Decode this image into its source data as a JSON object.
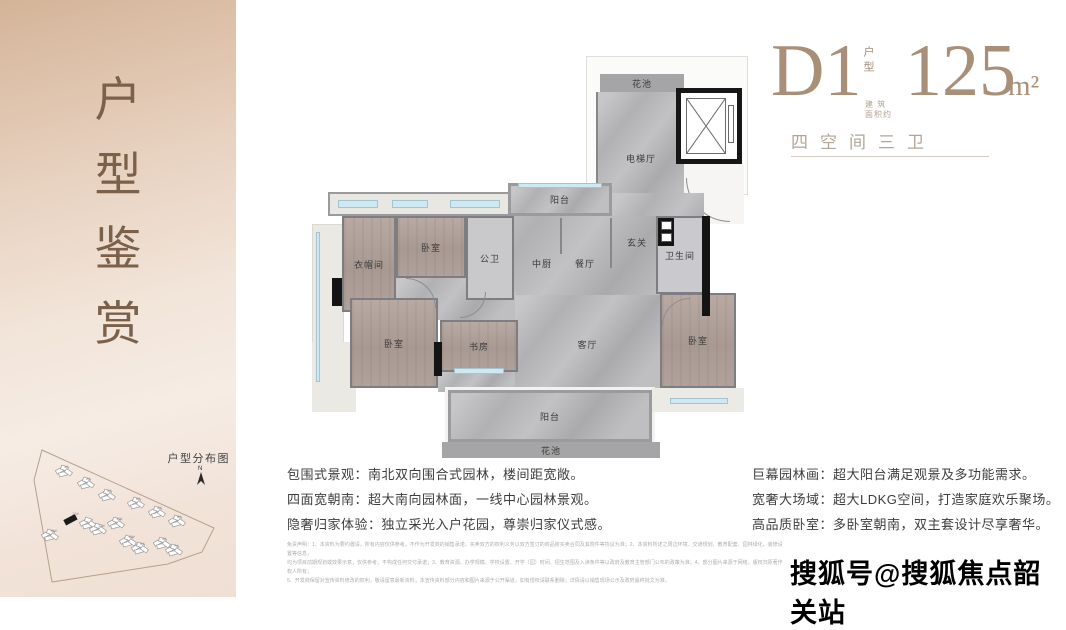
{
  "sidebar": {
    "title_chars": [
      "户",
      "型",
      "鉴",
      "赏"
    ],
    "sitemap": {
      "title": "户型分布图",
      "north_label": "N",
      "buildings": [
        "1#",
        "2#",
        "3#",
        "6#",
        "5#",
        "8#",
        "13#",
        "12#",
        "11#",
        "15#",
        "10#",
        "9#",
        "4#",
        "7#"
      ]
    }
  },
  "header": {
    "unit_code": "D1",
    "unit_code_note": "户型",
    "area_value": "125",
    "area_unit": "m²",
    "area_note_line1": "建 筑",
    "area_note_line2": "面积约",
    "subtitle": "四空间三卫"
  },
  "floorplan": {
    "rooms": {
      "flower_bed_top": "花池",
      "elevator_hall": "电梯厅",
      "balcony_top": "阳台",
      "bedroom_top": "卧室",
      "cloakroom": "衣帽间",
      "public_bath": "公卫",
      "kitchen": "中厨",
      "dining": "餐厅",
      "foyer": "玄关",
      "bathroom": "卫生间",
      "bedroom_left": "卧室",
      "study": "书房",
      "living": "客厅",
      "bedroom_right": "卧室",
      "balcony_bottom": "阳台",
      "flower_bed_bottom": "花池"
    }
  },
  "features_left": [
    "包围式景观：南北双向围合式园林，楼间距宽敞。",
    "四面宽朝南：超大南向园林面，一线中心园林景观。",
    "隐奢归家体验：独立采光入户花园，尊崇归家仪式感。"
  ],
  "features_right": [
    "巨幕园林画：超大阳台满足观景及多功能需求。",
    "宽奢大场域：超大LDKG空间，打造家庭欢乐聚场。",
    "高品质卧室：多卧室朝南，双主套设计尽享奢华。"
  ],
  "disclaimer_lines": [
    "免责声明：1、本资料为要约邀请，所有内容仅供参考，不作为开发商的销售承诺，买卖双方的权利义务以双方签订的商品房买卖合同及其附件等协议为准；2、本资料所述之周边环境、交通规划、教育配套、园林绿化、装修设置等信息，",
    "均为项目前期规划或效果示意，仅供参考，不构成任何交付承诺；3、教育资源、办学规模、学校设置、开学（园）时间、招生范围及入读条件等以政府及教育主管部门公布的政策为准；4、部分图片来源于网络，版权归原著作权人所有；",
    "5、开发商保留对宣传资料修改的权利，敬请留意最新资料；本宣传资料部分内容和图片来源于公开渠道，如有侵权请联系删除；详情请以销售现场公示及政府最终批文为准。"
  ],
  "watermark": "搜狐号@搜狐焦点韶关站",
  "colors": {
    "accent_brown": "#a98f78",
    "subtitle_gray": "#b2a698",
    "marble_floor": "#b6b6b8",
    "wood_floor": "#ab9d95",
    "wall_black": "#141414",
    "window_blue": "#cfe9f2",
    "sidebar_top": "#d3b498",
    "sidebar_bottom": "#efdfd5"
  }
}
